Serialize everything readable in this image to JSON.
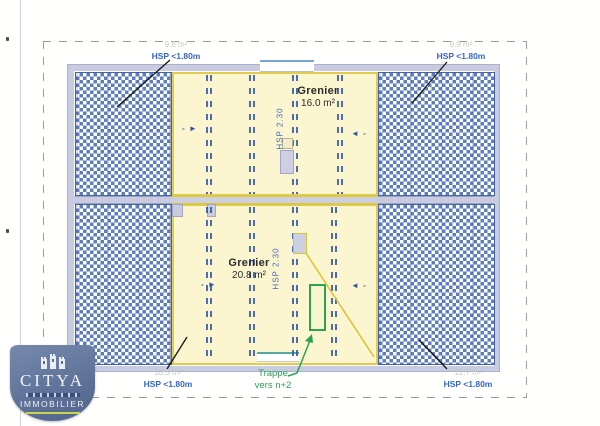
{
  "plan": {
    "room_top": {
      "name": "Grenier",
      "area": "16.0 m²",
      "height_note": "HSP 2.30"
    },
    "room_bottom": {
      "name": "Grenier",
      "area": "20.8 m²",
      "height_note": "HSP 2.30"
    },
    "corner_top_left": {
      "area": "9.8 m²",
      "note": "HSP <1.80m"
    },
    "corner_top_right": {
      "area": "9.9 m²",
      "note": "HSP <1.80m"
    },
    "corner_bottom_left": {
      "area": "10.5 m²",
      "note": "HSP <1.80m"
    },
    "corner_bottom_right": {
      "area": "12.7 m²",
      "note": "HSP <1.80m"
    },
    "trappe_label_line1": "Trappe",
    "trappe_label_line2": "vers n+2"
  },
  "icons": {
    "slope_arrow_from_left": "- ►",
    "slope_arrow_from_right": "◄ -"
  },
  "logo": {
    "brand": "CITYA",
    "division": "IMMOBILIER"
  },
  "colors": {
    "hatch_blue": "#5e7cbf",
    "hatch_border_blue": "#4262ad",
    "zone_yellow_fill": "#fbf6cf",
    "zone_yellow_line": "#e0cd4f",
    "wall_lavender": "#c9cbe0",
    "hsp_label_blue": "#3565c8",
    "joist_blue": "#2f55a5",
    "trappe_green": "#2aa355",
    "faint_label_gray": "#c8c8c2",
    "logo_slate_blue": "#5a6d94"
  }
}
